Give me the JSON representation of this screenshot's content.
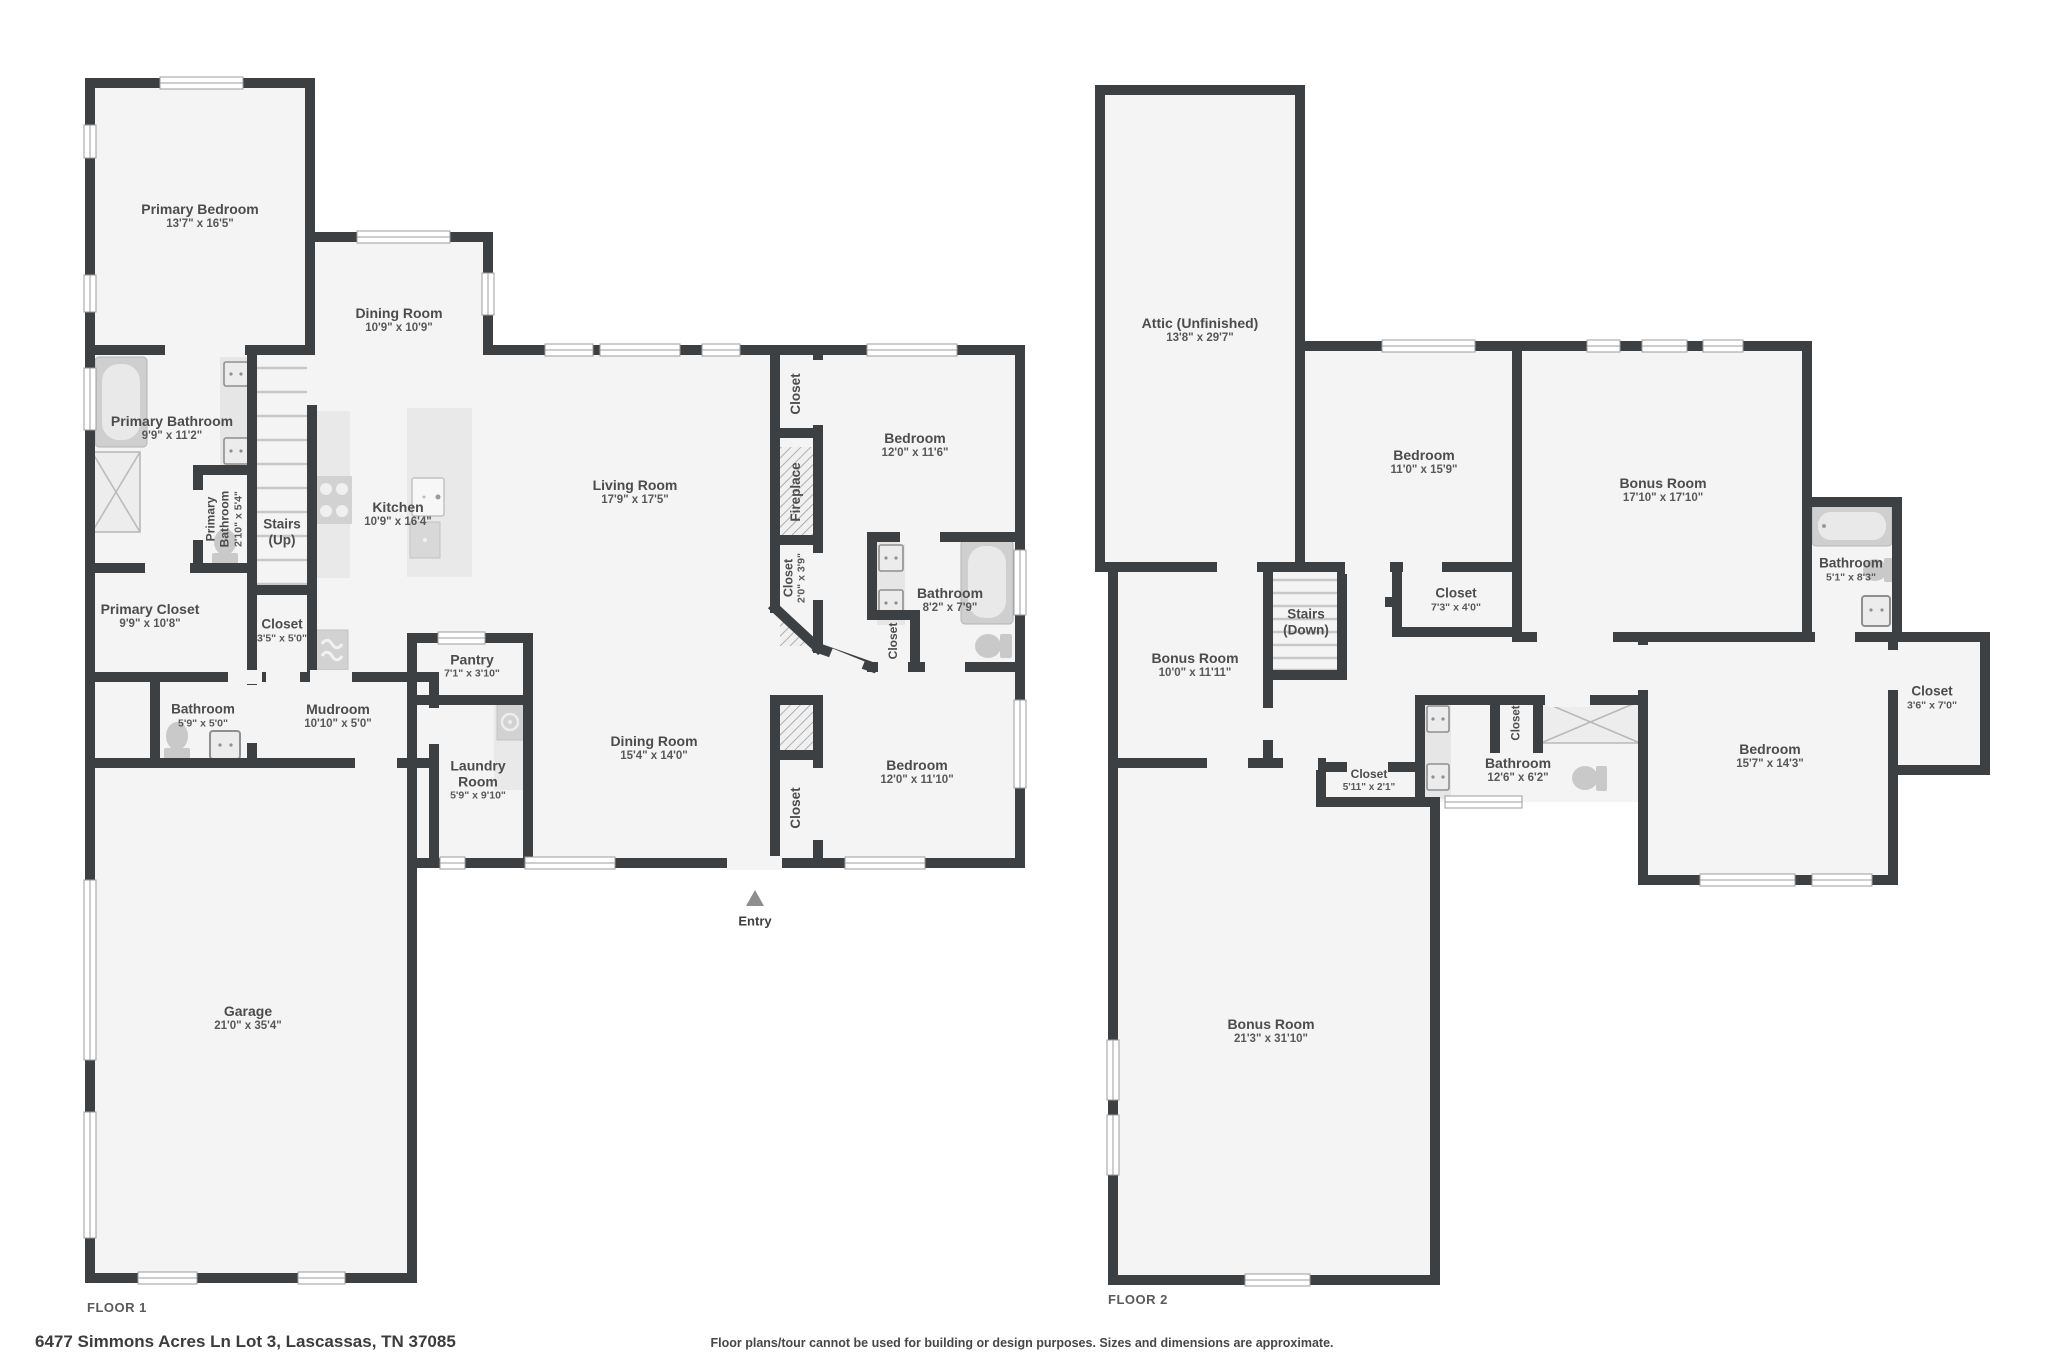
{
  "meta": {
    "type": "real-estate-floor-plan"
  },
  "colors": {
    "background": "#ffffff",
    "wall": "#3d4043",
    "room_fill": "#f4f4f5",
    "fixture": "#d2d2d2",
    "fixture_light": "#e9e9e9",
    "window_line": "#9c9c9c",
    "hatch_line": "#9f9f9f",
    "label_text": "#4c4c4c"
  },
  "icons": {
    "entry_arrow": "triangle-up",
    "bathtub": "rounded-rect-tub",
    "toilet": "bowl-and-tank",
    "sink": "square-basin",
    "stove": "four-burners",
    "refrigerator": "wave-lines",
    "washer": "front-load-circle",
    "shower": "x-box",
    "fireplace": "diagonal-hatch",
    "stairs": "tread-lines",
    "window": "double-line-gap"
  },
  "floor1": {
    "label": "FLOOR 1",
    "rooms": {
      "primary_bedroom": {
        "name": "Primary Bedroom",
        "dims": "13'7\" x 16'5\""
      },
      "dining_room_upper": {
        "name": "Dining Room",
        "dims": "10'9\" x 10'9\""
      },
      "primary_bathroom": {
        "name": "Primary Bathroom",
        "dims": "9'9\" x 11'2\""
      },
      "primary_bathroom_wc": {
        "name": "Primary Bathroom",
        "dims": "2'10\" x 5'4\""
      },
      "stairs_up": {
        "name": "Stairs",
        "dims": "(Up)"
      },
      "kitchen": {
        "name": "Kitchen",
        "dims": "10'9\" x 16'4\""
      },
      "living_room": {
        "name": "Living Room",
        "dims": "17'9\" x 17'5\""
      },
      "closet_living": {
        "name": "Closet"
      },
      "fireplace": {
        "name": "Fireplace"
      },
      "closet_hall_upper": {
        "name": "Closet",
        "dims": "2'0\" x 3'9\""
      },
      "bedroom_upper": {
        "name": "Bedroom",
        "dims": "12'0\" x 11'6\""
      },
      "bathroom_hall": {
        "name": "Bathroom",
        "dims": "8'2\" x 7'9\""
      },
      "closet_bathroom": {
        "name": "Closet"
      },
      "primary_closet": {
        "name": "Primary Closet",
        "dims": "9'9\" x 10'8\""
      },
      "closet_stairs": {
        "name": "Closet",
        "dims": "3'5\" x 5'0\""
      },
      "bathroom_mud": {
        "name": "Bathroom",
        "dims": "5'9\" x 5'0\""
      },
      "mudroom": {
        "name": "Mudroom",
        "dims": "10'10\" x 5'0\""
      },
      "pantry": {
        "name": "Pantry",
        "dims": "7'1\" x 3'10\""
      },
      "laundry_room": {
        "name": "Laundry Room",
        "dims": "5'9\" x 9'10\""
      },
      "dining_room_main": {
        "name": "Dining Room",
        "dims": "15'4\" x 14'0\""
      },
      "bedroom_lower": {
        "name": "Bedroom",
        "dims": "12'0\" x 11'10\""
      },
      "closet_bedroom_lower": {
        "name": "Closet"
      },
      "garage": {
        "name": "Garage",
        "dims": "21'0\" x 35'4\""
      },
      "entry": {
        "name": "Entry"
      }
    }
  },
  "floor2": {
    "label": "FLOOR 2",
    "rooms": {
      "attic": {
        "name": "Attic (Unfinished)",
        "dims": "13'8\" x 29'7\""
      },
      "bedroom_left": {
        "name": "Bedroom",
        "dims": "11'0\" x 15'9\""
      },
      "bonus_room_upper": {
        "name": "Bonus Room",
        "dims": "17'10\" x 17'10\""
      },
      "bathroom_small": {
        "name": "Bathroom",
        "dims": "5'1\" x 8'3\""
      },
      "stairs_down": {
        "name": "Stairs",
        "dims": "(Down)"
      },
      "closet_bedroom_left": {
        "name": "Closet",
        "dims": "7'3\" x 4'0\""
      },
      "bonus_room_mid": {
        "name": "Bonus Room",
        "dims": "10'0\" x 11'11\""
      },
      "closet_far_right": {
        "name": "Closet",
        "dims": "3'6\" x 7'0\""
      },
      "bedroom_right": {
        "name": "Bedroom",
        "dims": "15'7\" x 14'3\""
      },
      "bathroom_main": {
        "name": "Bathroom",
        "dims": "12'6\" x 6'2\""
      },
      "closet_hall": {
        "name": "Closet",
        "dims": "5'11\" x 2'1\""
      },
      "closet_bathroom2": {
        "name": "Closet"
      },
      "bonus_room_large": {
        "name": "Bonus Room",
        "dims": "21'3\" x 31'10\""
      }
    }
  },
  "footer": {
    "address": "6477 Simmons Acres Ln Lot 3, Lascassas, TN 37085",
    "disclaimer": "Floor plans/tour cannot be used for building or design purposes. Sizes and dimensions are approximate."
  }
}
